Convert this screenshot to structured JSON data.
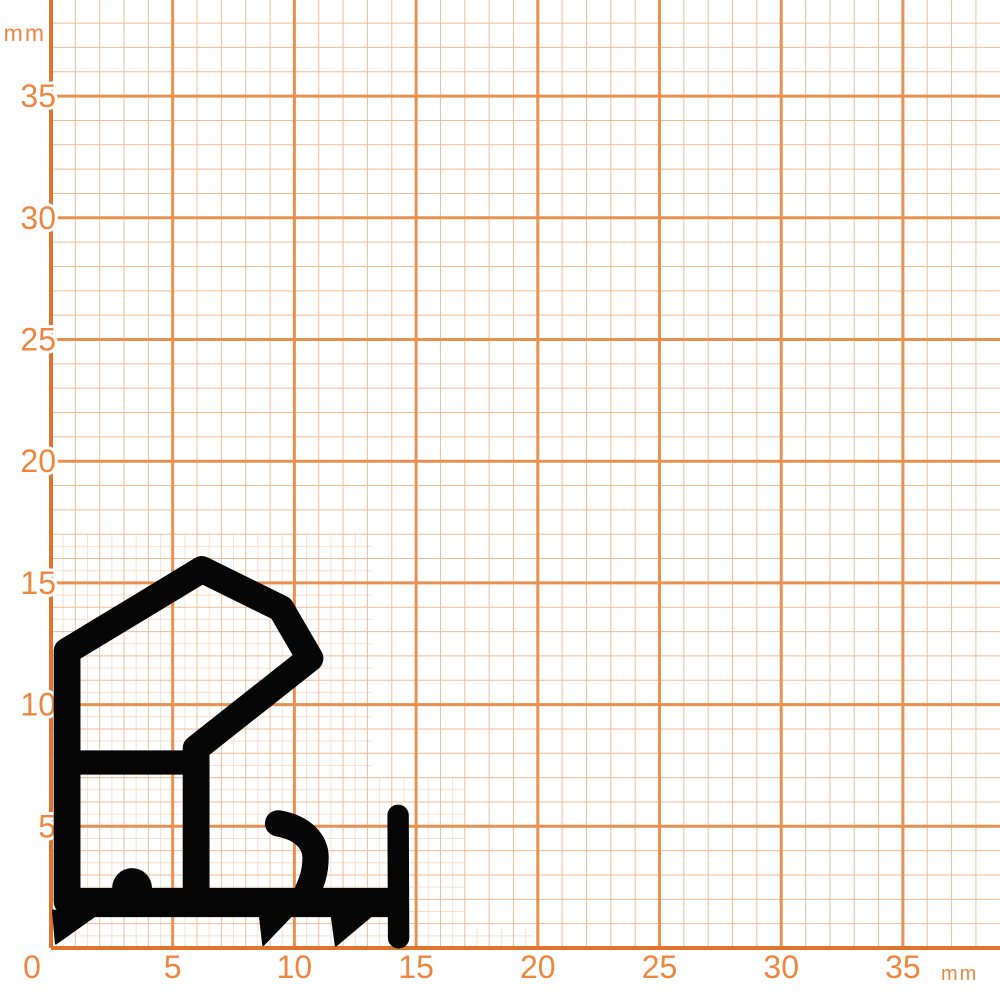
{
  "diagram": {
    "description": "Seal profile cross-section drawn on millimeter graph paper",
    "unit": "mm",
    "canvas": {
      "width": 1000,
      "height": 1000,
      "background": "#ffffff"
    },
    "axes": {
      "origin_px": {
        "x": 51,
        "y": 948
      },
      "px_per_mm": 24.34,
      "x_tick_labels": [
        "0",
        "5",
        "10",
        "15",
        "20",
        "25",
        "30",
        "35"
      ],
      "y_tick_labels": [
        "5",
        "10",
        "15",
        "20",
        "25",
        "30",
        "35"
      ],
      "x_unit_label": "mm",
      "y_unit_label": "mm",
      "tick_step_mm": 5,
      "label_color": "#ee8640",
      "number_font_px": 32,
      "unit_font_px": 23
    },
    "grid": {
      "minor_step_mm": 1,
      "subminor_step_mm": 0.5,
      "major_step_mm": 5,
      "extent_minor_mm": 38,
      "colors": {
        "axis": "#e1742c",
        "major": "#ea9150",
        "minor": "#f1bd95",
        "subminor": "#f8e1cf"
      },
      "widths_px": {
        "axis": 4,
        "major": 3,
        "minor": 1,
        "subminor": 1
      },
      "subminor_regions_mm": [
        {
          "x0": 0,
          "x1": 13.2,
          "y0": 0,
          "y1": 17
        },
        {
          "x0": 13.2,
          "x1": 17,
          "y0": 0,
          "y1": 7
        },
        {
          "x0": 17,
          "x1": 19.8,
          "y0": 0,
          "y1": 0.8
        }
      ]
    },
    "profile": {
      "color": "#060606",
      "strokes_mm": [
        {
          "name": "main-outline",
          "type": "polyline",
          "width": 1.1,
          "cap": "round",
          "points": [
            [
              0.66,
              1.9
            ],
            [
              0.66,
              12.2
            ],
            [
              6.2,
              15.55
            ],
            [
              9.45,
              13.95
            ],
            [
              10.64,
              11.9
            ],
            [
              5.96,
              8.2
            ],
            [
              5.96,
              1.9
            ]
          ]
        },
        {
          "name": "crossbar",
          "type": "polyline",
          "width": 1.0,
          "cap": "butt",
          "points": [
            [
              0.66,
              7.62
            ],
            [
              5.96,
              7.62
            ]
          ]
        },
        {
          "name": "base-bar",
          "type": "polyline",
          "width": 1.2,
          "cap": "butt",
          "points": [
            [
              0.62,
              1.87
            ],
            [
              14.2,
              1.87
            ]
          ]
        },
        {
          "name": "lip-hook",
          "type": "path",
          "width": 1.08,
          "cap": "round",
          "d": "M 9.33 5.12 C 10.35 4.95 10.88 4.35 10.87 3.7 C 10.86 3.05 10.7 2.7 10.55 2.35"
        },
        {
          "name": "end-post",
          "type": "polyline",
          "width": 0.88,
          "cap": "round",
          "points": [
            [
              14.26,
              5.45
            ],
            [
              14.28,
              0.42
            ]
          ]
        }
      ],
      "fills_mm": [
        {
          "name": "dome-bump",
          "type": "circle",
          "cx": 3.33,
          "cy": 2.46,
          "r": 0.82
        },
        {
          "name": "foot-left",
          "type": "polygon",
          "points": [
            [
              0.08,
              1.55
            ],
            [
              0.2,
              0.18
            ],
            [
              1.75,
              1.28
            ]
          ]
        },
        {
          "name": "spike-1",
          "type": "polygon",
          "points": [
            [
              8.58,
              1.35
            ],
            [
              8.72,
              0.12
            ],
            [
              9.9,
              1.35
            ]
          ]
        },
        {
          "name": "spike-2",
          "type": "polygon",
          "points": [
            [
              11.53,
              1.35
            ],
            [
              11.7,
              0.1
            ],
            [
              13.2,
              1.35
            ]
          ]
        }
      ]
    }
  }
}
